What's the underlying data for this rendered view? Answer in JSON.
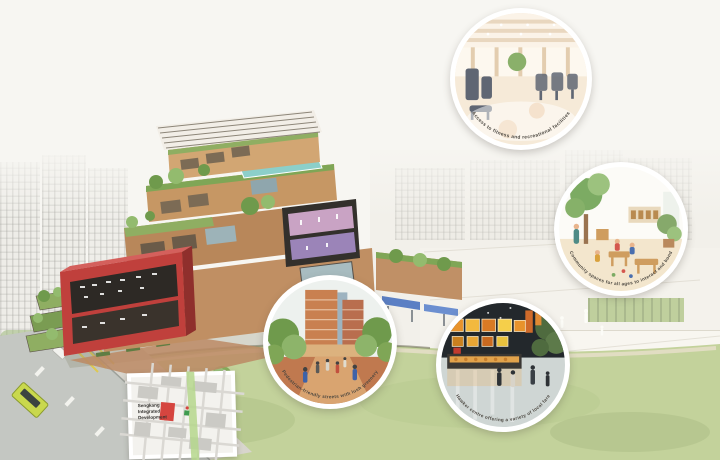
{
  "page": {
    "background": "#f7f6f2",
    "description": "Aerial watercolour rendering of an integrated community development with circular callout insets, surrounding city photos and a location map"
  },
  "palette": {
    "accent_red": "#c0403c",
    "accent_red_light": "#d4605c",
    "lawn_green": "#c3d29b",
    "pool_teal": "#8ccfc9",
    "tree_green": "#7fa656",
    "tree_green_light": "#9cc27e",
    "road_gray": "#c4c7c2",
    "bus_green": "#c9d84d",
    "plaza_brick": "#bc8a64",
    "map_red": "#d5453f",
    "map_green": "#b5d78c"
  },
  "insets": [
    {
      "id": "fitness",
      "scene": "gym-interior-rendering",
      "caption": "Access to fitness and recreational facilities"
    },
    {
      "id": "childcare",
      "scene": "childcare-interior-rendering",
      "caption": "Community spaces for all ages to interact and bond"
    },
    {
      "id": "street",
      "scene": "street-plaza-rendering",
      "caption": "Pedestrian-friendly streets with lush greenery"
    },
    {
      "id": "hawker",
      "scene": "hawker-centre-rendering",
      "caption": "Hawker centre offering a variety of local fare"
    }
  ],
  "map_inset": {
    "label_lines": [
      "Sengkang",
      "Integrated",
      "Development"
    ]
  }
}
